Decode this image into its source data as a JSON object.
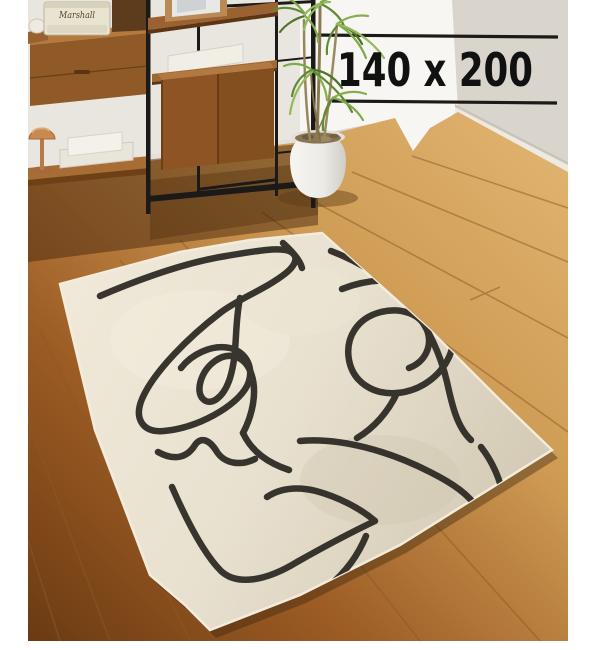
{
  "overlay": {
    "size_label": "140 x 200",
    "rule_color": "#1c1a18",
    "text_color": "#111111"
  },
  "scene": {
    "speaker_brand": "Marshall"
  },
  "colors": {
    "page_background": "#ffffff",
    "wall": "#dad6ce",
    "wall_bright": "#f7f6f3",
    "baseboard": "#eeeae2",
    "floor_light": "#dfb271",
    "floor_dark": "#6b3a12",
    "rug_base": "#ece4d3",
    "rug_shaded": "#d8cfbb",
    "rug_line": "#2e2b25",
    "frame_metal": "#1b1a18",
    "wood_furniture": "#8f5a28",
    "speaker_body": "#e9e4d2",
    "lamp_copper": "#c68a52",
    "plant_green": "#6f9a3d",
    "pot_white": "#f3f2ee"
  }
}
